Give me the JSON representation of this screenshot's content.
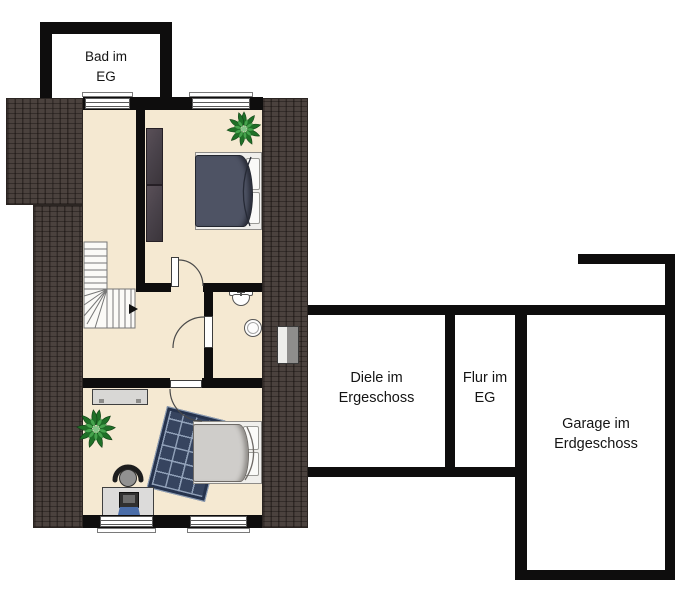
{
  "plan_title": "Floor plan (attic level with ground-floor room outlines)",
  "rooms": {
    "bad": {
      "line1": "Bad im",
      "line2": "EG"
    },
    "diele": {
      "line1": "Diele im",
      "line2": "Ergeschoss"
    },
    "flur": {
      "line1": "Flur im",
      "line2": "EG"
    },
    "garage": {
      "line1": "Garage im",
      "line2": "Erdgeschoss"
    }
  },
  "furniture_symbols": [
    "staircase",
    "wardrobe",
    "double-bed",
    "potted-plant",
    "toilet",
    "wash-basin",
    "sideboard",
    "rug",
    "desk",
    "office-chair",
    "laptop",
    "roof-window",
    "door",
    "window"
  ],
  "colors": {
    "background": "#ffffff",
    "wall": "#0e0d0d",
    "floor_cream": "#f5e9d2",
    "roof_dark": "#4b423e",
    "bed1_duvet": "#4e5364",
    "bed2_duvet": "#cfcdca",
    "rug_navy": "#26334d",
    "rug_grid": "#8fa0b8",
    "wardrobe": "#4a434b",
    "plant_green_dark": "#1f7027",
    "plant_green_light": "#46a34d",
    "furniture_gray": "#d8d7d5",
    "laptop_screen": "#4a6da8",
    "label_text": "#141414"
  }
}
